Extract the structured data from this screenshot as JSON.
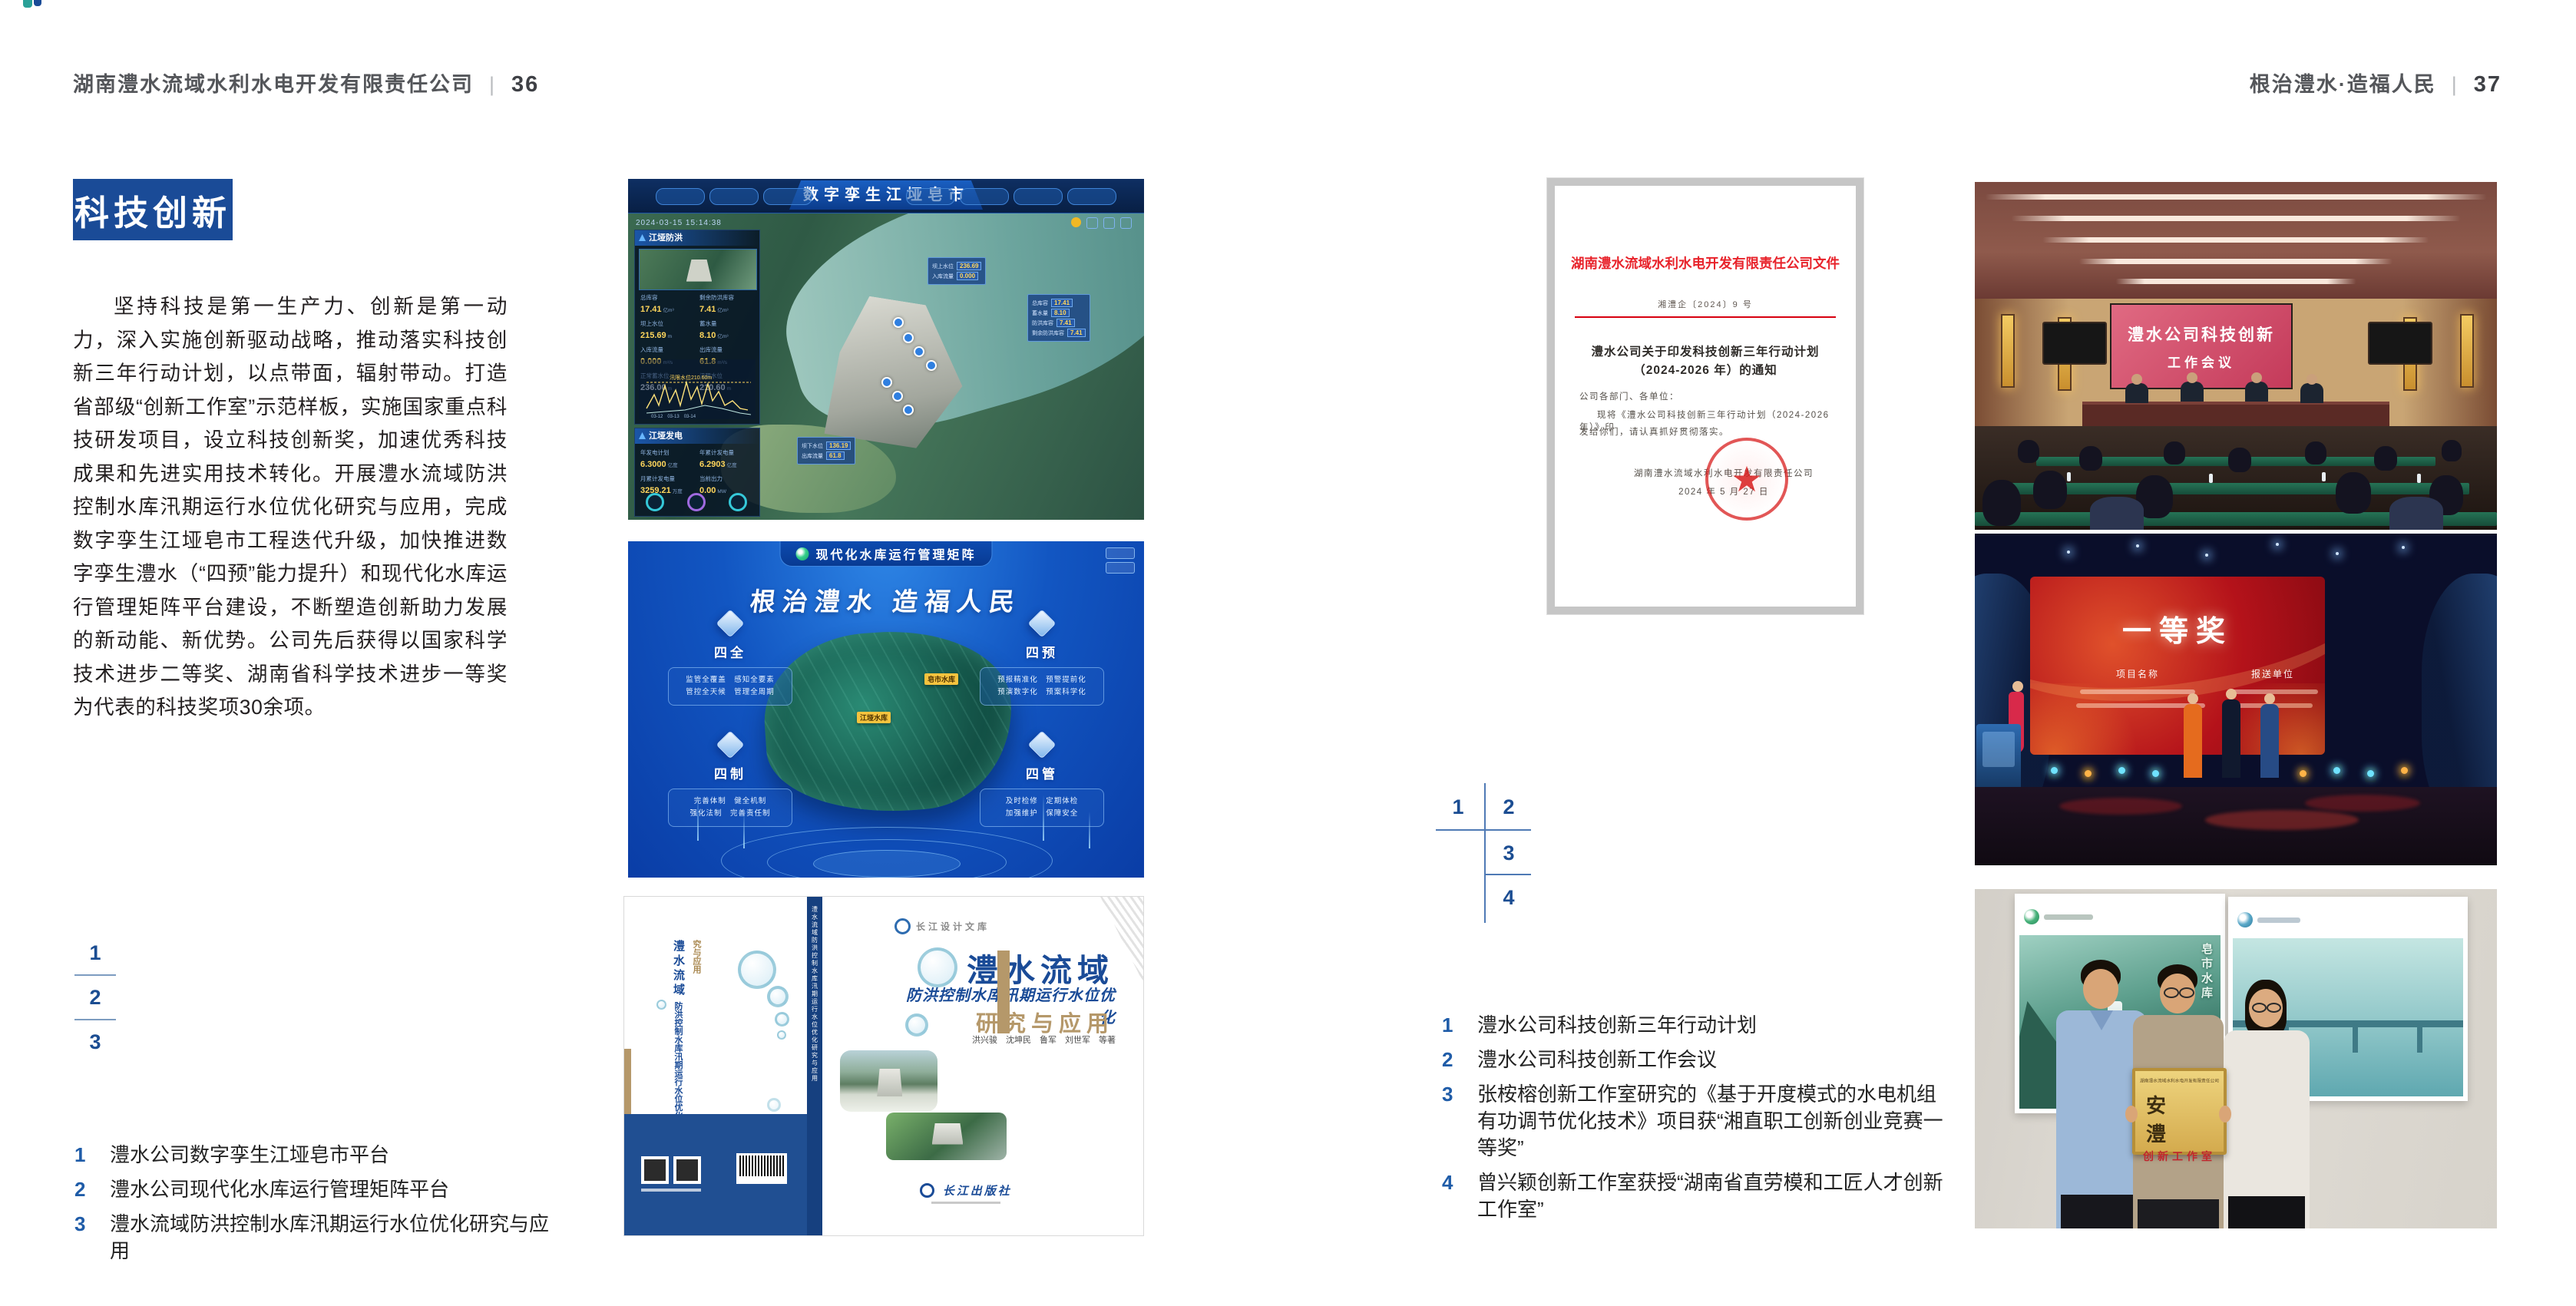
{
  "left_page": {
    "header": {
      "company": "湖南澧水流域水利水电开发有限责任公司",
      "divider": "|",
      "page_number": "36"
    },
    "badge": "科技创新",
    "paragraph": "坚持科技是第一生产力、创新是第一动力，深入实施创新驱动战略，推动落实科技创新三年行动计划，以点带面，辐射带动。打造省部级“创新工作室”示范样板，实施国家重点科技研发项目，设立科技创新奖，加速优秀科技成果和先进实用技术转化。开展澧水流域防洪控制水库汛期运行水位优化研究与应用，完成数字孪生江垭皂市工程迭代升级，加快推进数字孪生澧水（“四预”能力提升）和现代化水库运行管理矩阵平台建设，不断塑造创新助力发展的新动能、新优势。公司先后获得以国家科学技术进步二等奖、湖南省科学技术进步一等奖为代表的科技奖项30余项。",
    "figure_markers": [
      "1",
      "2",
      "3"
    ],
    "captions": [
      {
        "num": "1",
        "text": "澧水公司数字孪生江垭皂市平台"
      },
      {
        "num": "2",
        "text": "澧水公司现代化水库运行管理矩阵平台"
      },
      {
        "num": "3",
        "text": "澧水流域防洪控制水库汛期运行水位优化研究与应用"
      }
    ]
  },
  "right_page": {
    "header": {
      "motto": "根治澧水·造福人民",
      "divider": "|",
      "page_number": "37"
    },
    "figure_markers": [
      "1",
      "2",
      "3",
      "4"
    ],
    "captions": [
      {
        "num": "1",
        "text": "澧水公司科技创新三年行动计划"
      },
      {
        "num": "2",
        "text": "澧水公司科技创新工作会议"
      },
      {
        "num": "3",
        "text": "张桉榕创新工作室研究的《基于开度模式的水电机组有功调节优化技术》项目获“湘直职工创新创业竞赛一等奖”"
      },
      {
        "num": "4",
        "text": "曾兴颖创新工作室获授“湖南省直劳模和工匠人才创新工作室”"
      }
    ]
  },
  "dashboard": {
    "title": "数字孪生江垭皂市",
    "datetime": "2024-03-15 15:14:38",
    "flood_panel": {
      "title": "江垭防洪",
      "stats": [
        {
          "label": "总库容",
          "value": "17.41",
          "unit": "亿m³"
        },
        {
          "label": "剩余防洪库容",
          "value": "7.41",
          "unit": "亿m³"
        },
        {
          "label": "坝上水位",
          "value": "215.69",
          "unit": "m"
        },
        {
          "label": "蓄水量",
          "value": "8.10",
          "unit": "亿m³"
        },
        {
          "label": "入库流量",
          "value": "0.000",
          "unit": "m³/s"
        },
        {
          "label": "出库流量",
          "value": "61.8",
          "unit": "m³/s"
        },
        {
          "label": "正常蓄水位",
          "value": "236.00",
          "unit": "m"
        },
        {
          "label": "汛限水位",
          "value": "210.60",
          "unit": "m"
        }
      ],
      "chart_note": "汛限水位210.60m",
      "chart_x": "03-12　03-13　03-14"
    },
    "power_panel": {
      "title": "江垭发电",
      "stats": [
        {
          "label": "年发电计划",
          "value": "6.3000",
          "unit": "亿度"
        },
        {
          "label": "年累计发电量",
          "value": "6.2903",
          "unit": "亿度"
        },
        {
          "label": "月累计发电量",
          "value": "3259.21",
          "unit": "万度"
        },
        {
          "label": "当前出力",
          "value": "0.00",
          "unit": "MW"
        }
      ]
    },
    "callout_up": [
      {
        "label": "坝上水位",
        "value": "236.69"
      },
      {
        "label": "入库流量",
        "value": "0.000"
      }
    ],
    "callout_right": [
      {
        "label": "总库容",
        "value": "17.41"
      },
      {
        "label": "蓄水量",
        "value": "8.10"
      },
      {
        "label": "防洪库容",
        "value": "7.41"
      },
      {
        "label": "剩余防洪库容",
        "value": "7.41"
      }
    ],
    "callout_down": [
      {
        "label": "坝下水位",
        "value": "136.19"
      },
      {
        "label": "出库流量",
        "value": "61.8"
      }
    ]
  },
  "matrix": {
    "title": "现代化水库运行管理矩阵",
    "slogan": "根治澧水  造福人民",
    "corners": [
      {
        "title": "四全",
        "row1": "监管全覆盖　感知全要素",
        "row2": "管控全天候　管理全周期"
      },
      {
        "title": "四预",
        "row1": "预报精准化　预警提前化",
        "row2": "预演数字化　预案科学化"
      },
      {
        "title": "四制",
        "row1": "完善体制　健全机制",
        "row2": "强化法制　完善责任制"
      },
      {
        "title": "四管",
        "row1": "及时检修　定期体检",
        "row2": "加强维护　保障安全"
      }
    ],
    "tags": [
      "皂市水库",
      "江垭水库"
    ]
  },
  "book": {
    "series": "长江设计文库",
    "title1": "澧水流域",
    "title2": "防洪控制水库汛期运行水位优化",
    "title3": "研究与应用",
    "authors": "洪兴骏　沈坤民　鲁军　刘世军　等著",
    "publisher": "长江出版社",
    "spine": "澧水流域防洪控制水库汛期运行水位优化研究与应用"
  },
  "document": {
    "header": "湖南澧水流域水利水电开发有限责任公司文件",
    "number": "湘澧企〔2024〕9 号",
    "title_line1": "澧水公司关于印发科技创新三年行动计划",
    "title_line2": "（2024-2026 年）的通知",
    "salutation": "公司各部门、各单位：",
    "body_line1": "现将《澧水公司科技创新三年行动计划（2024-2026 年）》印",
    "body_line2": "发给你们，请认真抓好贯彻落实。",
    "signature": "湖南澧水流域水利水电开发有限责任公司",
    "date": "2024 年 5 月 27 日"
  },
  "meeting_screen": {
    "line1": "澧水公司科技创新",
    "line2": "工作会议"
  },
  "award_screen": {
    "title": "一等奖",
    "col1": "项目名称",
    "col2": "报送单位"
  },
  "plaque": {
    "org": "湖南澧水流域水利水电开发有限责任公司",
    "main": "安　澧",
    "sub": "创新工作室"
  },
  "poster_label": "皂市水库"
}
